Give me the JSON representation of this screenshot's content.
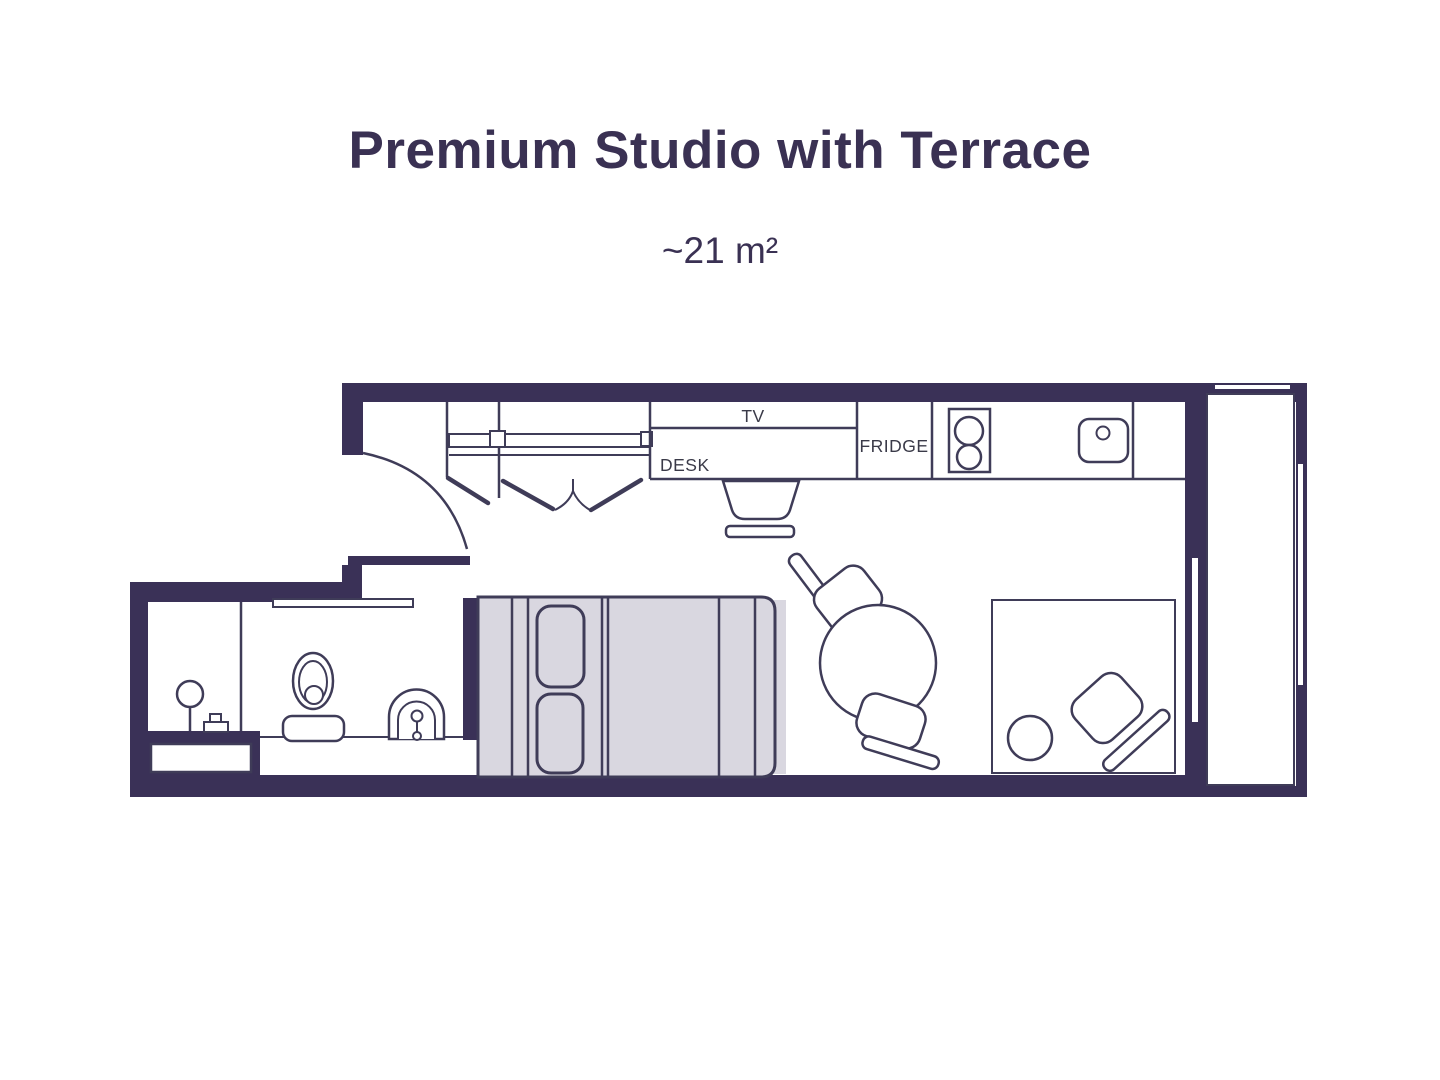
{
  "header": {
    "title": "Premium Studio with Terrace",
    "area": "~21 m²"
  },
  "plan": {
    "labels": {
      "tv": "TV",
      "desk": "DESK",
      "fridge": "FRIDGE"
    }
  },
  "colors": {
    "background": "#ffffff",
    "wall": "#3a3157",
    "outline": "#3f3c58",
    "bed_fill": "#d9d7e0",
    "title_text": "#3a3153",
    "label_text": "#3a3a48"
  }
}
